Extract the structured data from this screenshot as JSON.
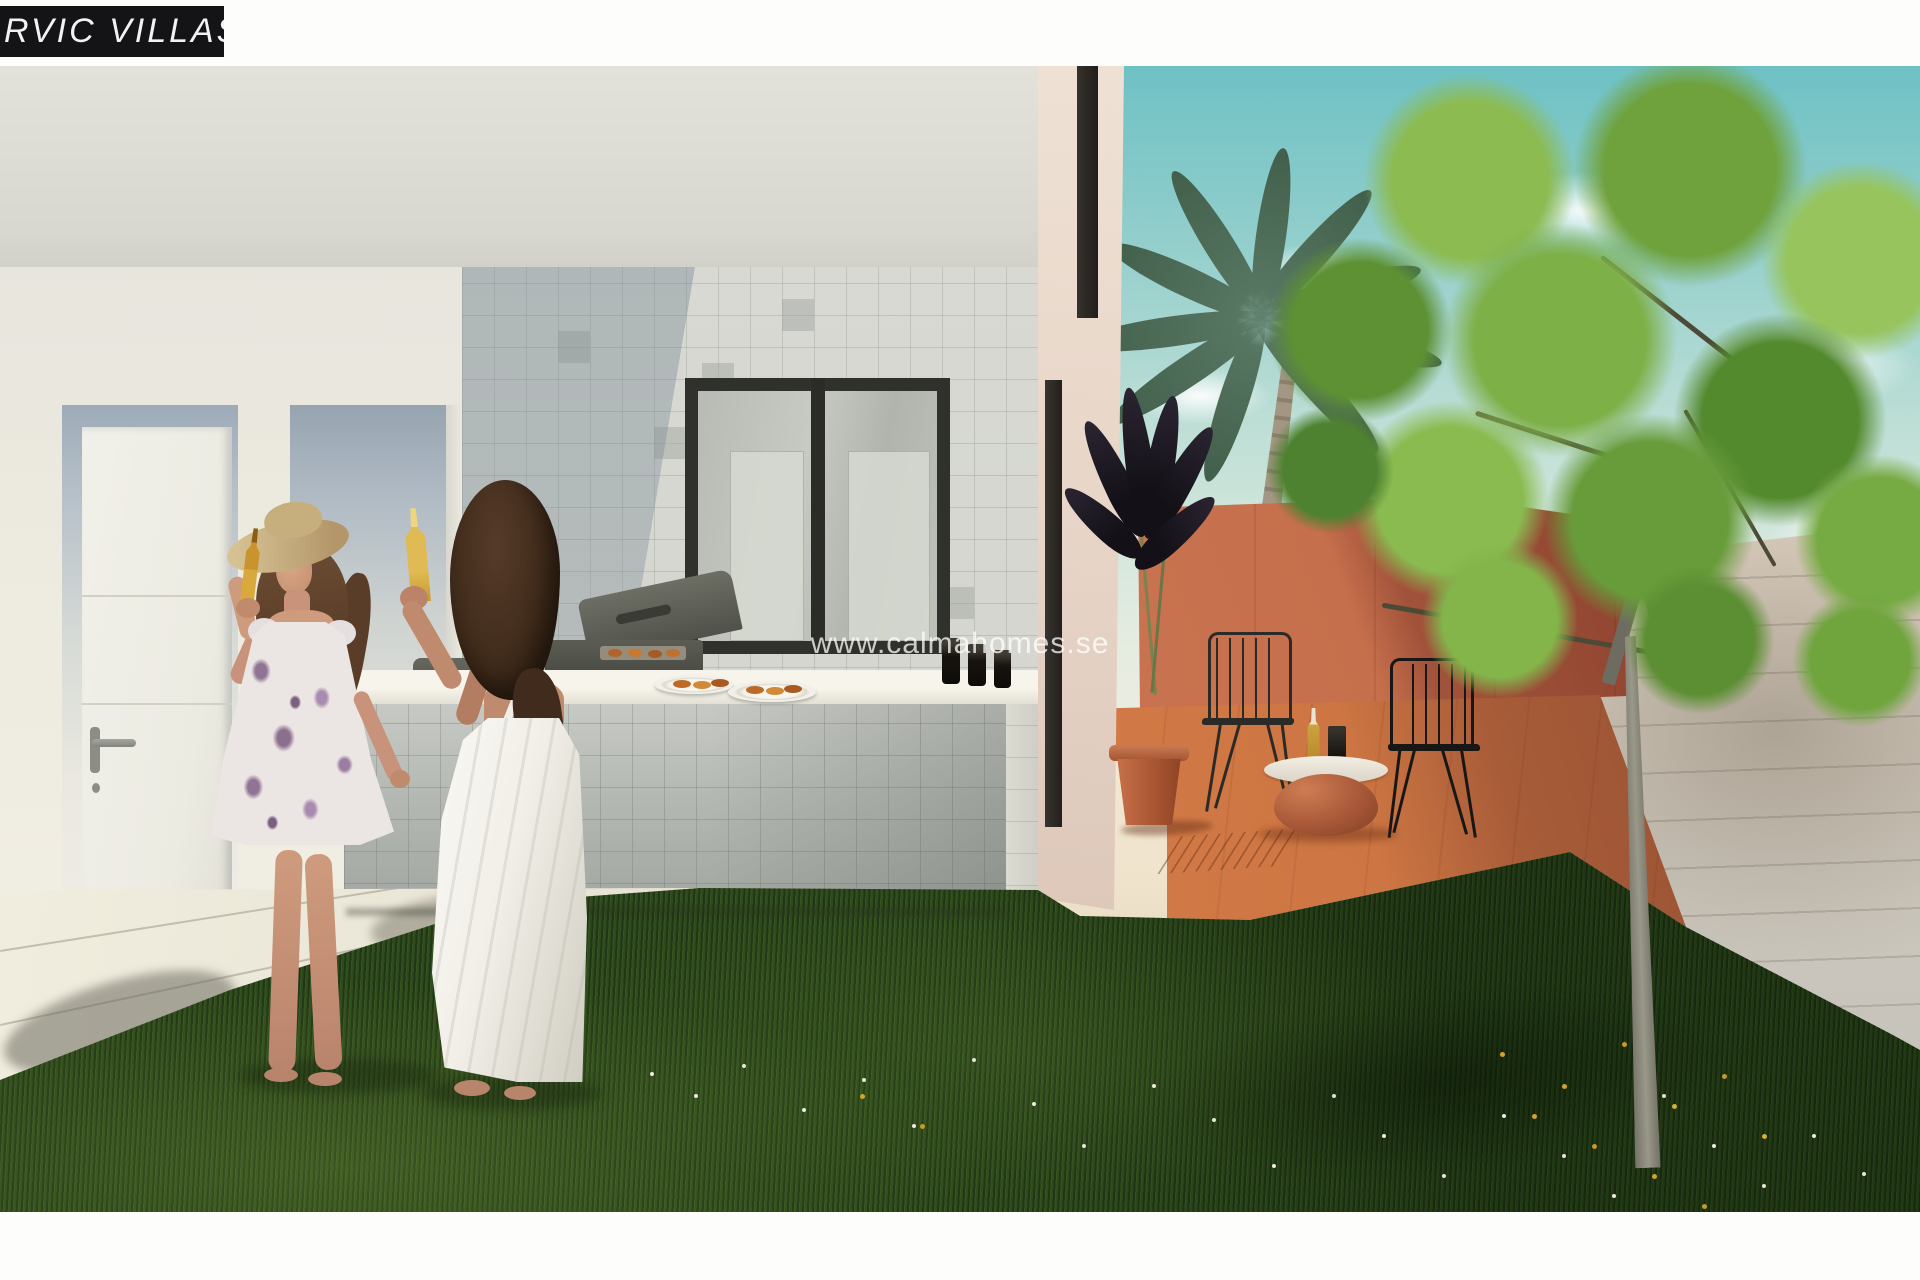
{
  "branding": {
    "label_text": "RVIC VILLAS",
    "label_bg": "#141416",
    "label_color": "#f2f2f2",
    "watermark_text": "www.calmahomes.se",
    "watermark_color": "rgba(255,255,255,0.75)"
  },
  "scene": {
    "setting": "Architectural render of a modern white villa garden: outdoor tiled BBQ counter, two women toasting with beer bottles on a lawn, terracotta patio with wire chairs and clay table, palm tree and leafy garden tree under a teal sky",
    "palette": {
      "wall_offwhite": "#e3e2da",
      "tile_grey": "#d5d6d0",
      "window_frame": "#30302c",
      "sky_teal": "#6ec1c4",
      "terracotta_wall_lit": "#c97350",
      "terracotta_wall_shade": "#8e4430",
      "patio_floor": "#ce7643",
      "terracotta_pot": "#aa5633",
      "grass_dark": "#2f4a1e",
      "tree_green": "#7eb048",
      "palm_green": "#415f4b",
      "perimeter_wall": "#d2cabd",
      "pavement": "#e9e5d6",
      "skin_tone": "#c8937a",
      "beer_amber": "#c9942e",
      "dress_floral_accent": "#8f7495",
      "dress_white": "#f1efe8"
    },
    "objects": [
      "villa-facade",
      "entrance-door",
      "recessed-niche",
      "tiled-wall",
      "window",
      "bbq-counter",
      "gas-grill",
      "countertop-appliance",
      "plates-with-food",
      "dark-tumblers",
      "woman-in-floral-dress",
      "woman-in-white-dress",
      "straw-hat",
      "beer-bottles",
      "lawn",
      "daisies",
      "pavement",
      "palm-tree",
      "garden-tree",
      "terracotta-patio-wall",
      "patio-floor",
      "wire-chair-left",
      "wire-chair-right",
      "round-clay-table",
      "table-bottle",
      "table-glass",
      "potted-dark-plant",
      "perimeter-wall",
      "sky",
      "clouds"
    ]
  }
}
